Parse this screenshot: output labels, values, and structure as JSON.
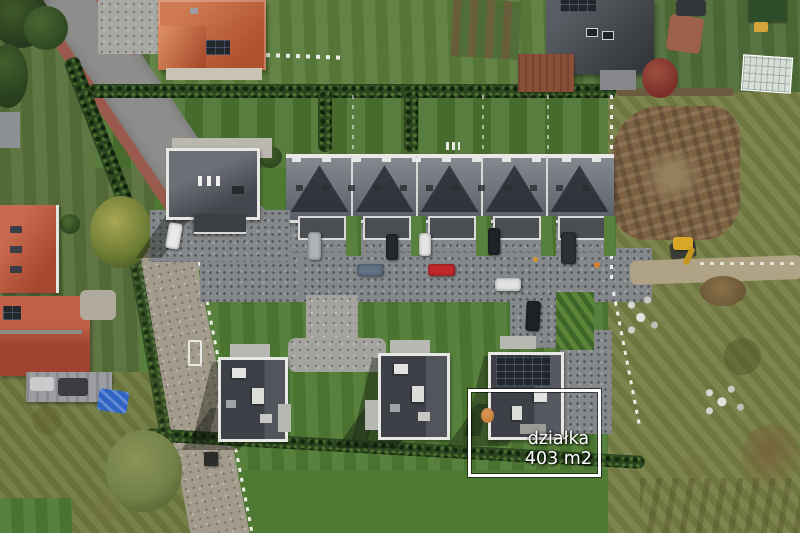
{
  "annotation": {
    "line1": "działka",
    "line2": "403 m2"
  },
  "palette": {
    "lawn": "#4e7a33",
    "lawn-bright": "#5b7d3c",
    "garden": "#4c7330",
    "scrub": "#767e44",
    "scrub-left": "#6f7a40",
    "hedge": "#2b4520",
    "dirt": "#7c6143",
    "cobble": "#85888b",
    "asphalt": "#8d8e8c",
    "gravel": "#a39b8c",
    "sidewalk": "#9a5a4d",
    "roof-dark": "#3f434a",
    "roof-gray": "#777b80",
    "roof-red": "#b4503a",
    "roof-orange": "#c06a45",
    "parapet": "#e7e7e4",
    "solar": "#23262b",
    "car-red": "#c1272b",
    "tarp-blue": "#2f64c4",
    "excavator-yellow": "#d9a728",
    "annotation-border": "#ffffff",
    "annotation-text": "#ffffff"
  }
}
